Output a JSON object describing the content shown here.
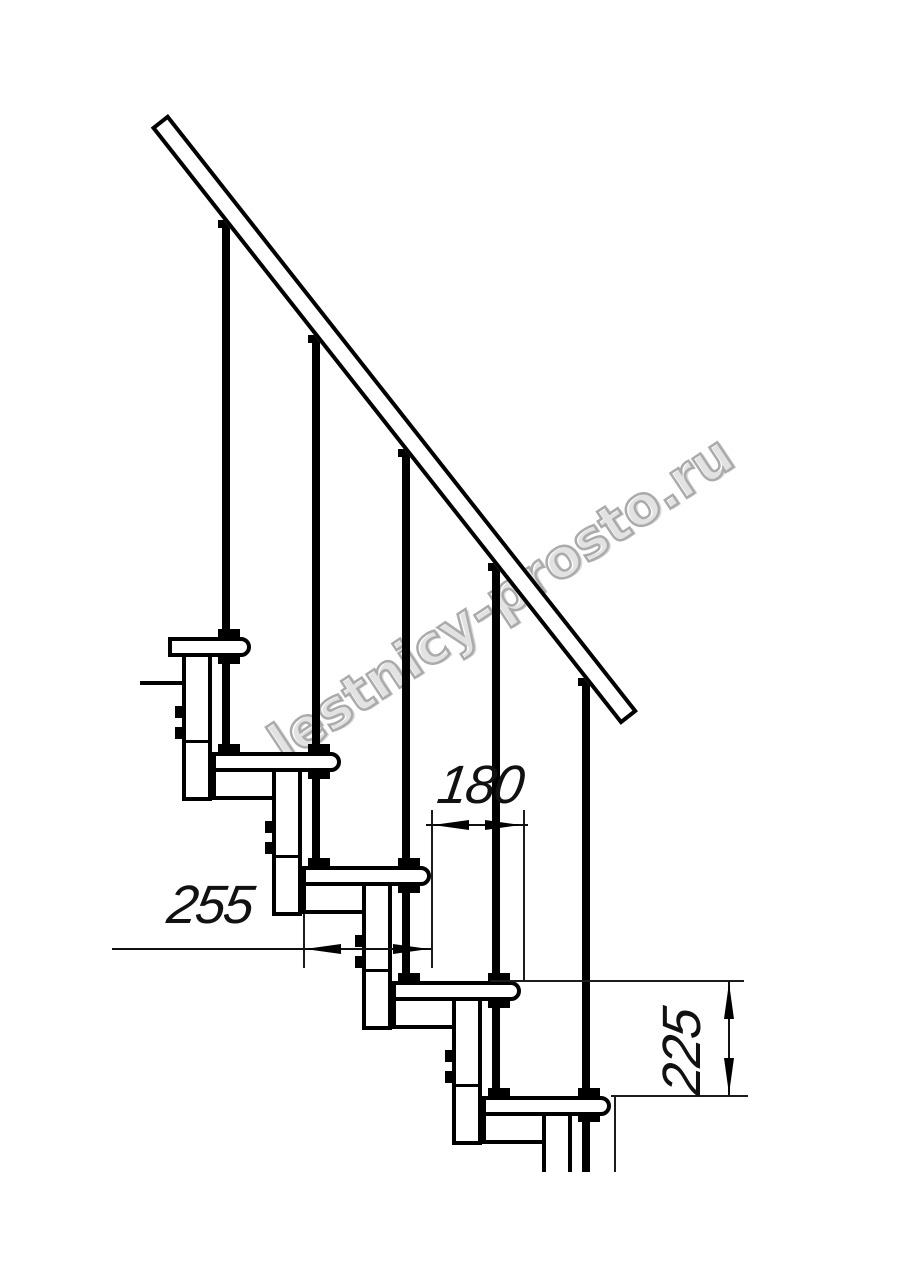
{
  "drawing": {
    "watermark": "lestnicy-prosto.ru",
    "dimensions": {
      "tread_depth": "255",
      "nose_pitch": "180",
      "step_rise": "225"
    }
  }
}
